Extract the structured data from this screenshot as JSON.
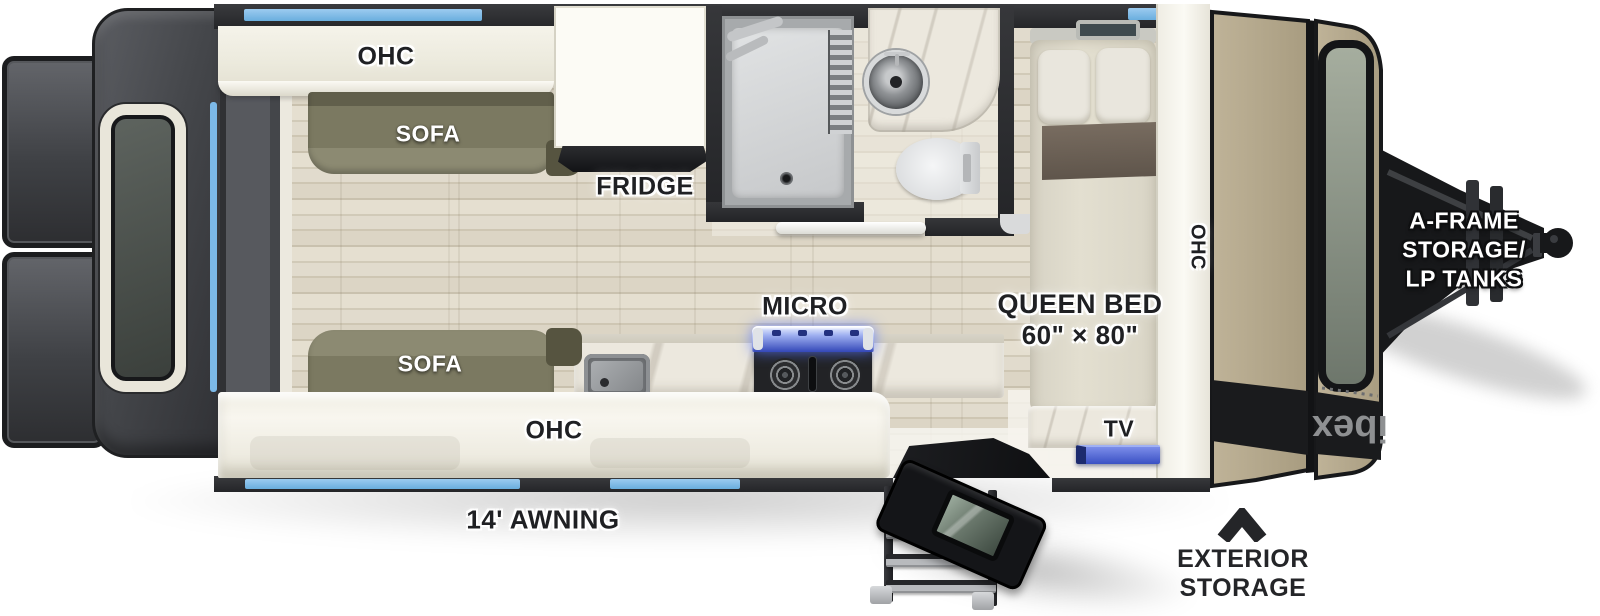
{
  "diagram": {
    "type": "travel-trailer-floorplan",
    "labels": {
      "ohc_top": "OHC",
      "sofa_top": "SOFA",
      "fridge": "FRIDGE",
      "micro": "MICRO",
      "queen_bed_line1": "QUEEN BED",
      "queen_bed_line2": "60\" × 80\"",
      "tv": "TV",
      "ohc_front": "OHC",
      "sofa_bottom": "SOFA",
      "ohc_bottom": "OHC",
      "awning": "14' AWNING",
      "aframe_line1": "A-FRAME",
      "aframe_line2": "STORAGE/",
      "aframe_line3": "LP TANKS",
      "exterior_line1": "EXTERIOR",
      "exterior_line2": "STORAGE",
      "brand_logo": "ibex"
    },
    "colors": {
      "accent_blue": "#7cb9e8",
      "tv_blue": "#4a63cf",
      "sofa_olive": "#7b7961",
      "cap_tan": "#b4a88d",
      "wall_dark": "#2c2d30",
      "floor_wood": "#ddd7c9",
      "label_black": "#1f2023",
      "label_white": "#ffffff"
    }
  }
}
